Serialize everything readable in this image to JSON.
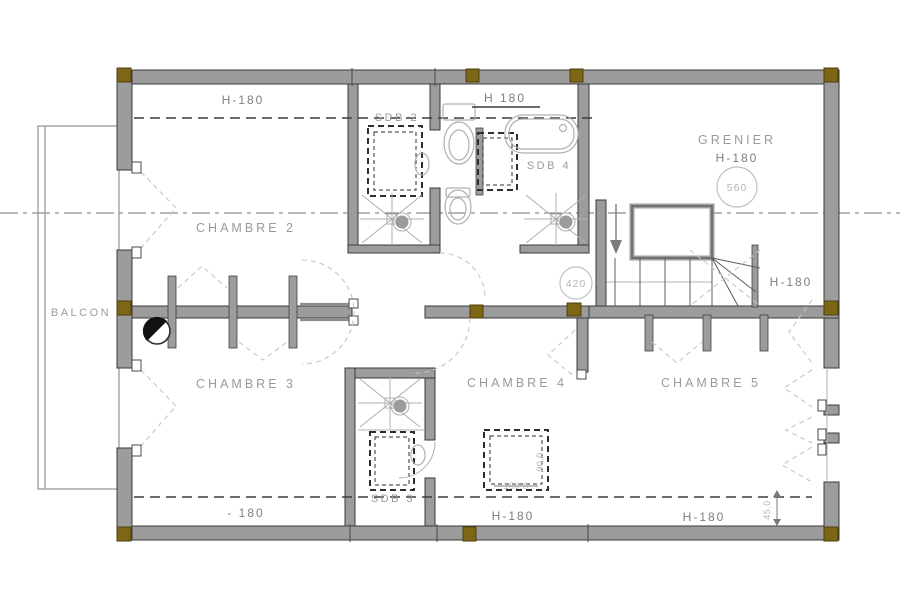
{
  "drawing": {
    "kind": "architectural-floor-plan"
  },
  "colors": {
    "bg": "#ffffff",
    "wall": "#9c9c9c",
    "wall-edge": "#3a3a3a",
    "post": "#7d6616",
    "post-edge": "#4f400c",
    "fixture": "#b0b0b0",
    "label": "#9a9a9a",
    "dim": "#7e7e7e",
    "dark-line": "#3f3f3f",
    "mid-line": "#6f6f6f",
    "swing": "#c6c6c6",
    "velux": "#2e2e2e",
    "marker": "#c2c2c2"
  },
  "rooms": {
    "balcon": "BALCON",
    "chambre2": "CHAMBRE 2",
    "chambre3": "CHAMBRE 3",
    "chambre4": "CHAMBRE 4",
    "chambre5": "CHAMBRE 5",
    "grenier": "GRENIER",
    "sdb2": "SDB 2",
    "sdb3": "SDB 3",
    "sdb4": "SDB 4"
  },
  "dims": {
    "h180_top_left": "H-180",
    "h180_top_center": "H 180",
    "h180_grenier": "H-180",
    "h180_stair": "H-180",
    "h180_bottom_left": "- 180",
    "h180_bottom_center": "H-180",
    "h180_bottom_right": "H-180",
    "right_offset": "45.0"
  },
  "markers": {
    "grenier_circle": "560",
    "hall_circle": "420"
  },
  "velux_ch4": {
    "width": "100.0",
    "height": "90.0"
  }
}
